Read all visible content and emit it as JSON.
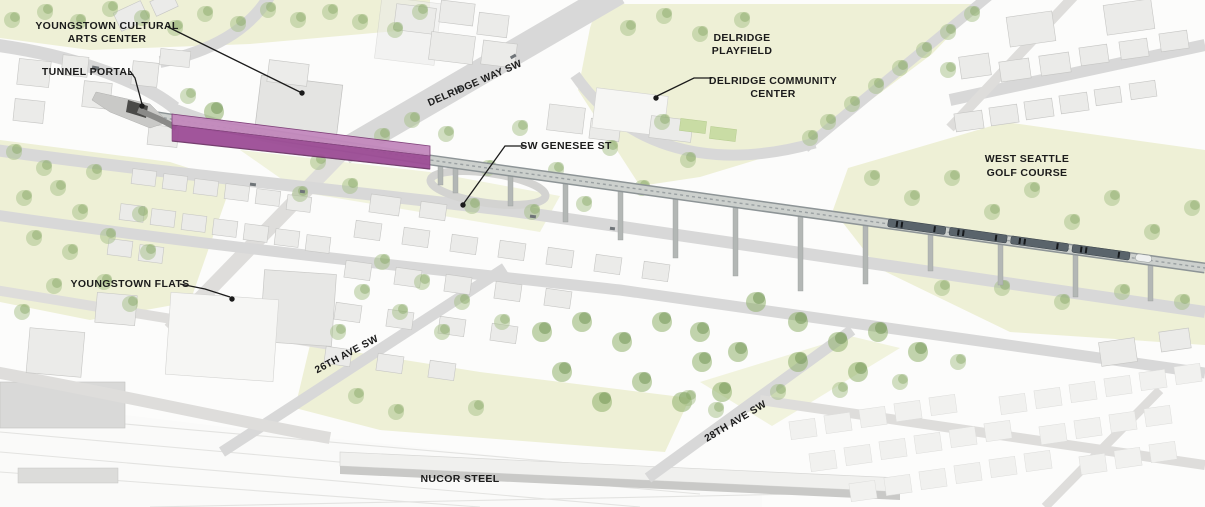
{
  "figure": {
    "kind": "aerial-project-rendering"
  },
  "labels": {
    "youngstown_cultural_arts_center": {
      "line1": "YOUNGSTOWN CULTURAL",
      "line2": "ARTS CENTER"
    },
    "tunnel_portal": "TUNNEL PORTAL",
    "delridge_playfield": {
      "line1": "DELRIDGE",
      "line2": "PLAYFIELD"
    },
    "delridge_community_center": {
      "line1": "DELRIDGE COMMUNITY",
      "line2": "CENTER"
    },
    "west_seattle_golf_course": {
      "line1": "WEST SEATTLE",
      "line2": "GOLF COURSE"
    },
    "sw_genesee_st": "SW GENESEE ST",
    "delridge_way_sw": "DELRIDGE WAY SW",
    "youngstown_flats": "YOUNGSTOWN FLATS",
    "ave_26th_sw": "26TH AVE SW",
    "ave_28th_sw": "28TH AVE SW",
    "nucor_steel": "NUCOR STEEL"
  },
  "colors": {
    "station_accent": "#9d4d96",
    "station_roof": "#c389bd",
    "field_green": "#eef0d6",
    "tree_green": "#a6bf87",
    "building_gray": "#ebebe9",
    "road_gray": "#d8d8d8",
    "guideway_gray": "#c7cbc8",
    "train_gray": "#5a646b",
    "label_black": "#1b1b1b"
  }
}
